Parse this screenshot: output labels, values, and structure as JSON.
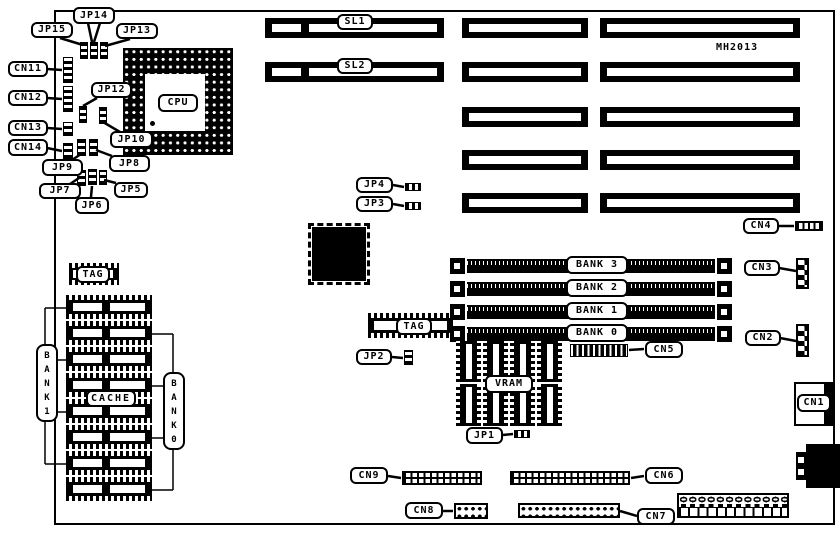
{
  "board": {
    "part_number": "MH2013"
  },
  "labels": {
    "jumpers": {
      "JP1": "JP1",
      "JP2": "JP2",
      "JP3": "JP3",
      "JP4": "JP4",
      "JP5": "JP5",
      "JP6": "JP6",
      "JP7": "JP7",
      "JP8": "JP8",
      "JP9": "JP9",
      "JP10": "JP10",
      "JP12": "JP12",
      "JP13": "JP13",
      "JP14": "JP14",
      "JP15": "JP15"
    },
    "connectors": {
      "CN1": "CN1",
      "CN2": "CN2",
      "CN3": "CN3",
      "CN4": "CN4",
      "CN5": "CN5",
      "CN6": "CN6",
      "CN7": "CN7",
      "CN8": "CN8",
      "CN9": "CN9",
      "CN11": "CN11",
      "CN12": "CN12",
      "CN13": "CN13",
      "CN14": "CN14"
    },
    "slots": {
      "SL1": "SL1",
      "SL2": "SL2"
    },
    "chips": {
      "CPU": "CPU",
      "TAG_CACHE": "TAG",
      "TAG_VRAM": "TAG",
      "CACHE": "CACHE",
      "VRAM": "VRAM"
    },
    "simm_banks": {
      "BANK3": "BANK 3",
      "BANK2": "BANK 2",
      "BANK1": "BANK 1",
      "BANK0": "BANK 0"
    },
    "cache_banks": {
      "BANK1_VERT": "B\nA\nN\nK\n1",
      "BANK0_VERT": "B\nA\nN\nK\n0"
    }
  }
}
